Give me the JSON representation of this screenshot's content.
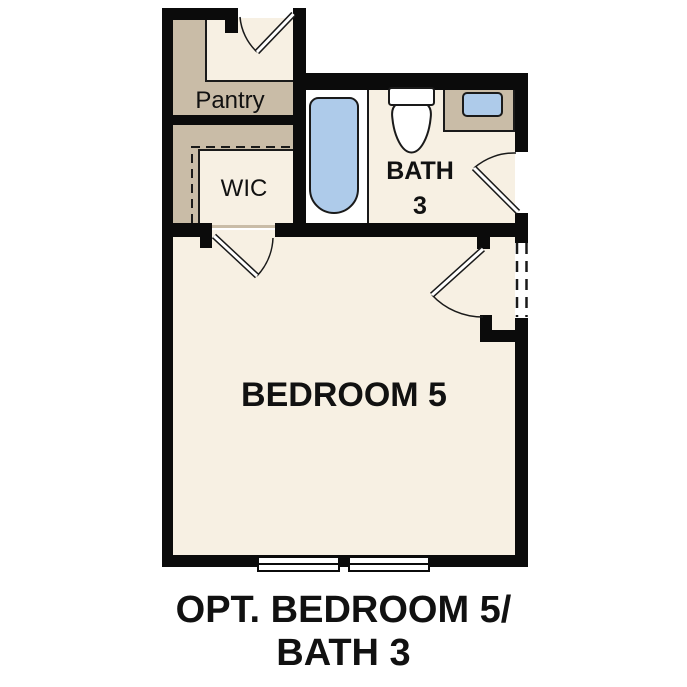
{
  "floorplan": {
    "rooms": {
      "pantry": {
        "label": "Pantry"
      },
      "wic": {
        "label": "WIC"
      },
      "bath": {
        "label": "BATH",
        "number": "3"
      },
      "bedroom": {
        "label": "BEDROOM 5"
      }
    },
    "caption": {
      "line1": "OPT. BEDROOM 5/",
      "line2": "BATH 3"
    },
    "colors": {
      "wall": "#0b0b0b",
      "floor": "#f7f0e3",
      "shading": "#c9bca7",
      "fixture_blue": "#aecbea",
      "fixture_white": "#ffffff",
      "outline": "#1a1a1a",
      "text": "#111111",
      "background": "#ffffff"
    }
  }
}
